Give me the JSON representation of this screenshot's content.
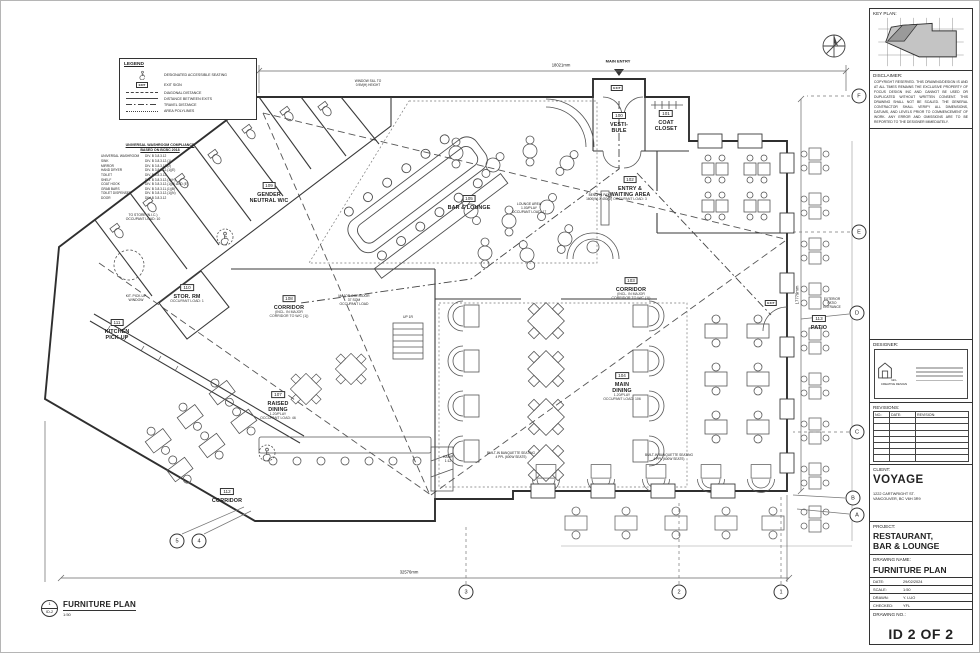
{
  "plan": {
    "exit_label": "EXIT",
    "rooms": [
      {
        "tag": "100",
        "name": "VESTI-\nBULE",
        "sub": "",
        "x": 618,
        "y": 118
      },
      {
        "tag": "101",
        "name": "COAT\nCLOSET",
        "sub": "",
        "x": 665,
        "y": 116
      },
      {
        "tag": "102",
        "name": "ENTRY &\nWAITING AREA",
        "sub": "OCCUPANT LOAD: 3",
        "x": 629,
        "y": 184
      },
      {
        "tag": "105",
        "name": "BAR & LOUNGE",
        "sub": "",
        "x": 468,
        "y": 198
      },
      {
        "tag": "109",
        "name": "GENDER\nNEUTRAL W/C",
        "sub": "",
        "x": 268,
        "y": 188
      },
      {
        "tag": "110",
        "name": "STOR. RM",
        "sub": "OCCUPANT LOAD: 1",
        "x": 186,
        "y": 289
      },
      {
        "tag": "111",
        "name": "KITCHEN\nPICK-UP",
        "sub": "",
        "x": 116,
        "y": 325
      },
      {
        "tag": "108",
        "name": "CORRIDOR",
        "sub": "(INCL. IN MAJOR\nCORRIDOR TO W/C (1))",
        "x": 288,
        "y": 302
      },
      {
        "tag": "103",
        "name": "CORRIDOR",
        "sub": "(INCL. IN MAJOR\nCORRIDOR TO W/C (1))",
        "x": 630,
        "y": 284
      },
      {
        "tag": "104",
        "name": "MAIN\nDINING",
        "sub": "1.20/PLAY\nOCCUPANT LOAD: 106",
        "x": 621,
        "y": 382
      },
      {
        "tag": "107",
        "name": "RAISED\nDINING",
        "sub": "1.20/PLAY\nOCCUPANT LOAD: 46",
        "x": 277,
        "y": 401
      },
      {
        "tag": "112",
        "name": "CORRIDOR",
        "sub": "",
        "x": 226,
        "y": 491
      },
      {
        "tag": "113",
        "name": "PATIO",
        "sub": "",
        "x": 818,
        "y": 318
      }
    ],
    "notes": [
      {
        "text": "MAIN ENTRY",
        "x": 617,
        "y": 61,
        "size": 4,
        "bold": true
      },
      {
        "text": "LOUNGE AREA\n1.00/PLAY\nOCCUPANT LOAD: 17",
        "x": 528,
        "y": 207,
        "size": 3.4
      },
      {
        "text": "MAJOR CORRIDOR\n37 SQM\nOCCUPANT LOAD",
        "x": 353,
        "y": 299,
        "size": 3.4
      },
      {
        "text": "KIT. PICK-UP\nWINDOW",
        "x": 135,
        "y": 297,
        "size": 3.4
      },
      {
        "text": "UP 1R",
        "x": 407,
        "y": 316,
        "size": 3.4
      },
      {
        "text": "RAMP\n1:12",
        "x": 447,
        "y": 458,
        "size": 3.4
      },
      {
        "text": "EXTERIOR\nPATIO\nENTRANCE",
        "x": 831,
        "y": 303,
        "size": 3.2
      },
      {
        "text": "WINDOW SILL TO\n0.9M(H) HEIGHT",
        "x": 367,
        "y": 83,
        "size": 3.2
      },
      {
        "text": "BENCH 4 PAX\n1600(W) X 450(D)",
        "x": 598,
        "y": 197,
        "size": 3.2
      },
      {
        "text": "BUILT-IN BANQUETTE SEATING\n4 PPL (600W SEATS)",
        "x": 510,
        "y": 455,
        "size": 3.2
      },
      {
        "text": "BUILT-IN BANQUETTE SEATING\n4 PPL (600W SEATS)",
        "x": 668,
        "y": 457,
        "size": 3.2
      },
      {
        "text": "TO STORE (N.I.C.)\nOCCUPANT LOAD: 10",
        "x": 142,
        "y": 216,
        "size": 3.4
      }
    ],
    "dims": [
      {
        "text": "18021mm",
        "x": 560,
        "y": 64,
        "rot": 0
      },
      {
        "text": "32576mm",
        "x": 408,
        "y": 571,
        "rot": 0
      },
      {
        "text": "17779mm",
        "x": 796,
        "y": 294,
        "rot": -90
      }
    ],
    "exits": [
      {
        "x": 616,
        "y": 87
      },
      {
        "x": 770,
        "y": 302
      }
    ],
    "grid_bubbles": [
      {
        "label": "F",
        "x": 858,
        "y": 95
      },
      {
        "label": "E",
        "x": 858,
        "y": 231
      },
      {
        "label": "D",
        "x": 856,
        "y": 312
      },
      {
        "label": "C",
        "x": 856,
        "y": 431
      },
      {
        "label": "B",
        "x": 852,
        "y": 497
      },
      {
        "label": "A",
        "x": 856,
        "y": 514
      },
      {
        "label": "5",
        "x": 176,
        "y": 540
      },
      {
        "label": "4",
        "x": 198,
        "y": 540
      },
      {
        "label": "3",
        "x": 465,
        "y": 591
      },
      {
        "label": "2",
        "x": 678,
        "y": 591
      },
      {
        "label": "1",
        "x": 780,
        "y": 591
      }
    ]
  },
  "legend": {
    "title": "LEGEND",
    "items": [
      {
        "symbol": "wheelchair",
        "label": "DESIGNATED ACCESSIBLE SEATING"
      },
      {
        "symbol": "exit",
        "label": "EXIT SIGN"
      },
      {
        "symbol": "dashed",
        "label": "DIAGONAL DISTANCE"
      },
      {
        "symbol": "solid",
        "label": "DISTANCE BETWEEN EXITS"
      },
      {
        "symbol": "dashdot",
        "label": "TRAVEL DISTANCE"
      },
      {
        "symbol": "dotted",
        "label": "AREA POLYLINES"
      }
    ]
  },
  "compliance": {
    "title1": "UNIVERSAL WASHROOM COMPLIANCE",
    "title2": "BASED ON BCBC 2018",
    "rows": [
      [
        "UNIVERSAL WASHROOM",
        "DIV. B 3.8.3.12"
      ],
      [
        "SINK",
        "DIV. B 3.8.3.12.(1)"
      ],
      [
        "MIRROR",
        "DIV. B 3.8.3.12.(2)"
      ],
      [
        "HAND DRYER",
        "DIV. B 3.8.3.12.(1)(E)"
      ],
      [
        "TOILET",
        "DIV. B 3.8.3.12"
      ],
      [
        "SHELF",
        "DIV. B 3.8.3.12.(1)(H)"
      ],
      [
        "COAT HOOK",
        "DIV. B 3.8.3.12.(1)(B) AND (E)"
      ],
      [
        "GRAB BARS",
        "DIV. B 3.8.3.11.(1)(B)"
      ],
      [
        "TOILET DISPENSER",
        "DIV. B 3.8.3.12.(1)(N)"
      ],
      [
        "DOOR",
        "DIV. B 3.8.3.12"
      ]
    ]
  },
  "titleblock": {
    "key_plan_label": "KEY PLAN:",
    "disclaimer_label": "DISCLAIMER:",
    "disclaimer_text": "COPYRIGHT RESERVED. THIS DRAWING/DESIGN IS AND AT ALL TIMES REMAINS THE EXCLUSIVE PROPERTY OF FOCUS DESIGN INC AND CANNOT BE USED OR DUPLICATED WITHOUT WRITTEN CONSENT. THIS DRAWING SHALL NOT BE SCALED. THE GENERAL CONTRACTOR SHALL VERIFY ALL DIMENSIONS, DATUMS, AND LEVELS PRIOR TO COMMENCEMENT OF WORK. ANY ERROR AND OMISSIONS ARE TO BE REPORTED TO THE DESIGNER IMMEDIATELY.",
    "designer_label": "DESIGNER:",
    "designer_name": "GFL\nCREATIVE DESIGN",
    "revisions_label": "REVISIONS:",
    "revisions_cols": [
      "NO.:",
      "DATE:",
      "REVISION:"
    ],
    "revisions_empty_rows": 7,
    "client_label": "CLIENT:",
    "client_name": "VOYAGE",
    "client_address": "1222 CARTWRIGHT ST.\nVANCOUVER, BC V6H 3R9",
    "project_label": "PROJECT:",
    "project_name": "RESTAURANT,\nBAR & LOUNGE",
    "drawing_name_label": "DRAWING NAME:",
    "drawing_name": "FURNITURE PLAN",
    "fields": [
      {
        "label": "DATE:",
        "value": "29/02/2024"
      },
      {
        "label": "SCALE:",
        "value": "1:50"
      },
      {
        "label": "DRAWN:",
        "value": "Y. LUO"
      },
      {
        "label": "CHECKED:",
        "value": "YFL"
      }
    ],
    "drawing_no_label": "DRAWING NO.:",
    "drawing_no": "ID 2 OF 2"
  },
  "view_title": {
    "num": "1",
    "sheet": "ID-2",
    "title": "FURNITURE PLAN",
    "scale": "1:50"
  },
  "colors": {
    "wall": "#2f2f2f",
    "furniture": "#555555",
    "light": "#888888",
    "keyplan_fill": "#c4c4c4"
  }
}
